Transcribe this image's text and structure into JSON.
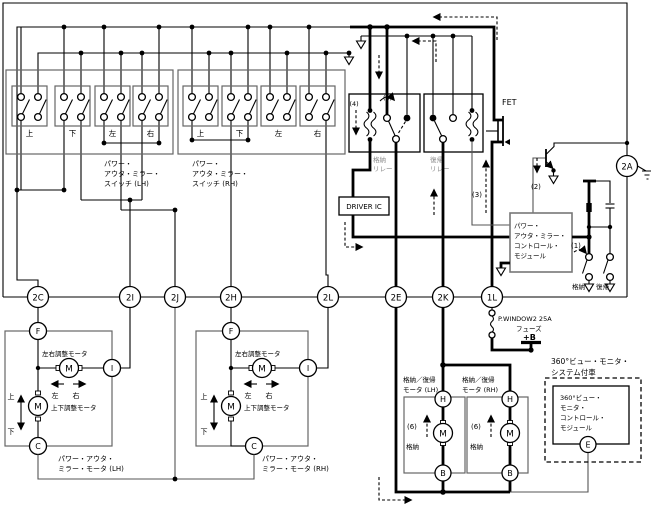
{
  "connectors": {
    "a2": "2A",
    "c2": "2C",
    "i2": "2I",
    "j2": "2J",
    "h2": "2H",
    "l2": "2L",
    "e2": "2E",
    "k2": "2K",
    "l1": "1L"
  },
  "sw_lh": {
    "l1": "パワー・",
    "l2": "アウタ・ミラー・",
    "l3": "スイッチ (LH)",
    "up": "上",
    "down": "下",
    "left": "左",
    "right": "右"
  },
  "sw_rh": {
    "l1": "パワー・",
    "l2": "アウタ・ミラー・",
    "l3": "スイッチ (RH)",
    "up": "上",
    "down": "下",
    "left": "左",
    "right": "右"
  },
  "relay": {
    "store1": "格納",
    "store2": "リレー",
    "ret1": "復帰",
    "ret2": "リレー"
  },
  "fet": "FET",
  "driver_ic": "DRIVER IC",
  "module": {
    "l1": "パワー・",
    "l2": "アウタ・ミラー・",
    "l3": "コントロール・",
    "l4": "モジュール"
  },
  "mod_sw": {
    "store": "格納",
    "ret": "復帰"
  },
  "ann": {
    "n1": "(1)",
    "n2": "(2)",
    "n3": "(3)",
    "n4": "(4)",
    "n5": "(5)",
    "n6a": "(6)",
    "n6b": "(6)"
  },
  "mirror_lh": {
    "f": "F",
    "i": "I",
    "c": "C",
    "m1": "M",
    "m2": "M",
    "lr": "左右調整モータ",
    "ud": "上下調整モータ",
    "left": "左",
    "right": "右",
    "up": "上",
    "down": "下",
    "name1": "パワー・アウタ・",
    "name2": "ミラー・モータ (LH)"
  },
  "mirror_rh": {
    "f": "F",
    "i": "I",
    "c": "C",
    "m1": "M",
    "m2": "M",
    "lr": "左右調整モータ",
    "ud": "上下調整モータ",
    "left": "左",
    "right": "右",
    "up": "上",
    "down": "下",
    "name1": "パワー・アウタ・",
    "name2": "ミラー・モータ (RH)"
  },
  "fuse": {
    "name": "P.WINDOW2 25A",
    "type": "フューズ",
    "pb": "+B"
  },
  "ret_lh": {
    "h": "H",
    "m": "M",
    "b": "B",
    "store": "格納",
    "name1": "格納／復帰",
    "name2": "モータ (LH)"
  },
  "ret_rh": {
    "h": "H",
    "m": "M",
    "b": "B",
    "store": "格納",
    "name1": "格納／復帰",
    "name2": "モータ (RH)"
  },
  "monitor": {
    "note1": "360°ビュー・モニタ・",
    "note2": "システム付車",
    "l1": "360°ビュー・",
    "l2": "モニタ・",
    "l3": "コントロール・",
    "l4": "モジュール",
    "e": "E"
  }
}
